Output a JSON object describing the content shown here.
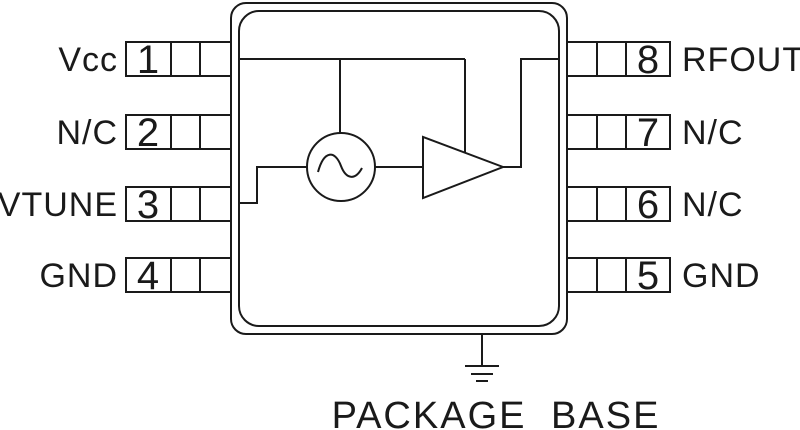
{
  "colors": {
    "line": "#1a1a1a",
    "background": "#ffffff"
  },
  "pins": {
    "left": [
      {
        "number": "1",
        "label": "Vcc"
      },
      {
        "number": "2",
        "label": "N/C"
      },
      {
        "number": "3",
        "label": "VTUNE"
      },
      {
        "number": "4",
        "label": "GND"
      }
    ],
    "right": [
      {
        "number": "8",
        "label": "RFOUT"
      },
      {
        "number": "7",
        "label": "N/C"
      },
      {
        "number": "6",
        "label": "N/C"
      },
      {
        "number": "5",
        "label": "GND"
      }
    ]
  },
  "components": {
    "oscillator": "sine-wave-oscillator",
    "amplifier": "amplifier-triangle",
    "ground": "ground-symbol"
  },
  "ground_label": "PACKAGE BASE"
}
